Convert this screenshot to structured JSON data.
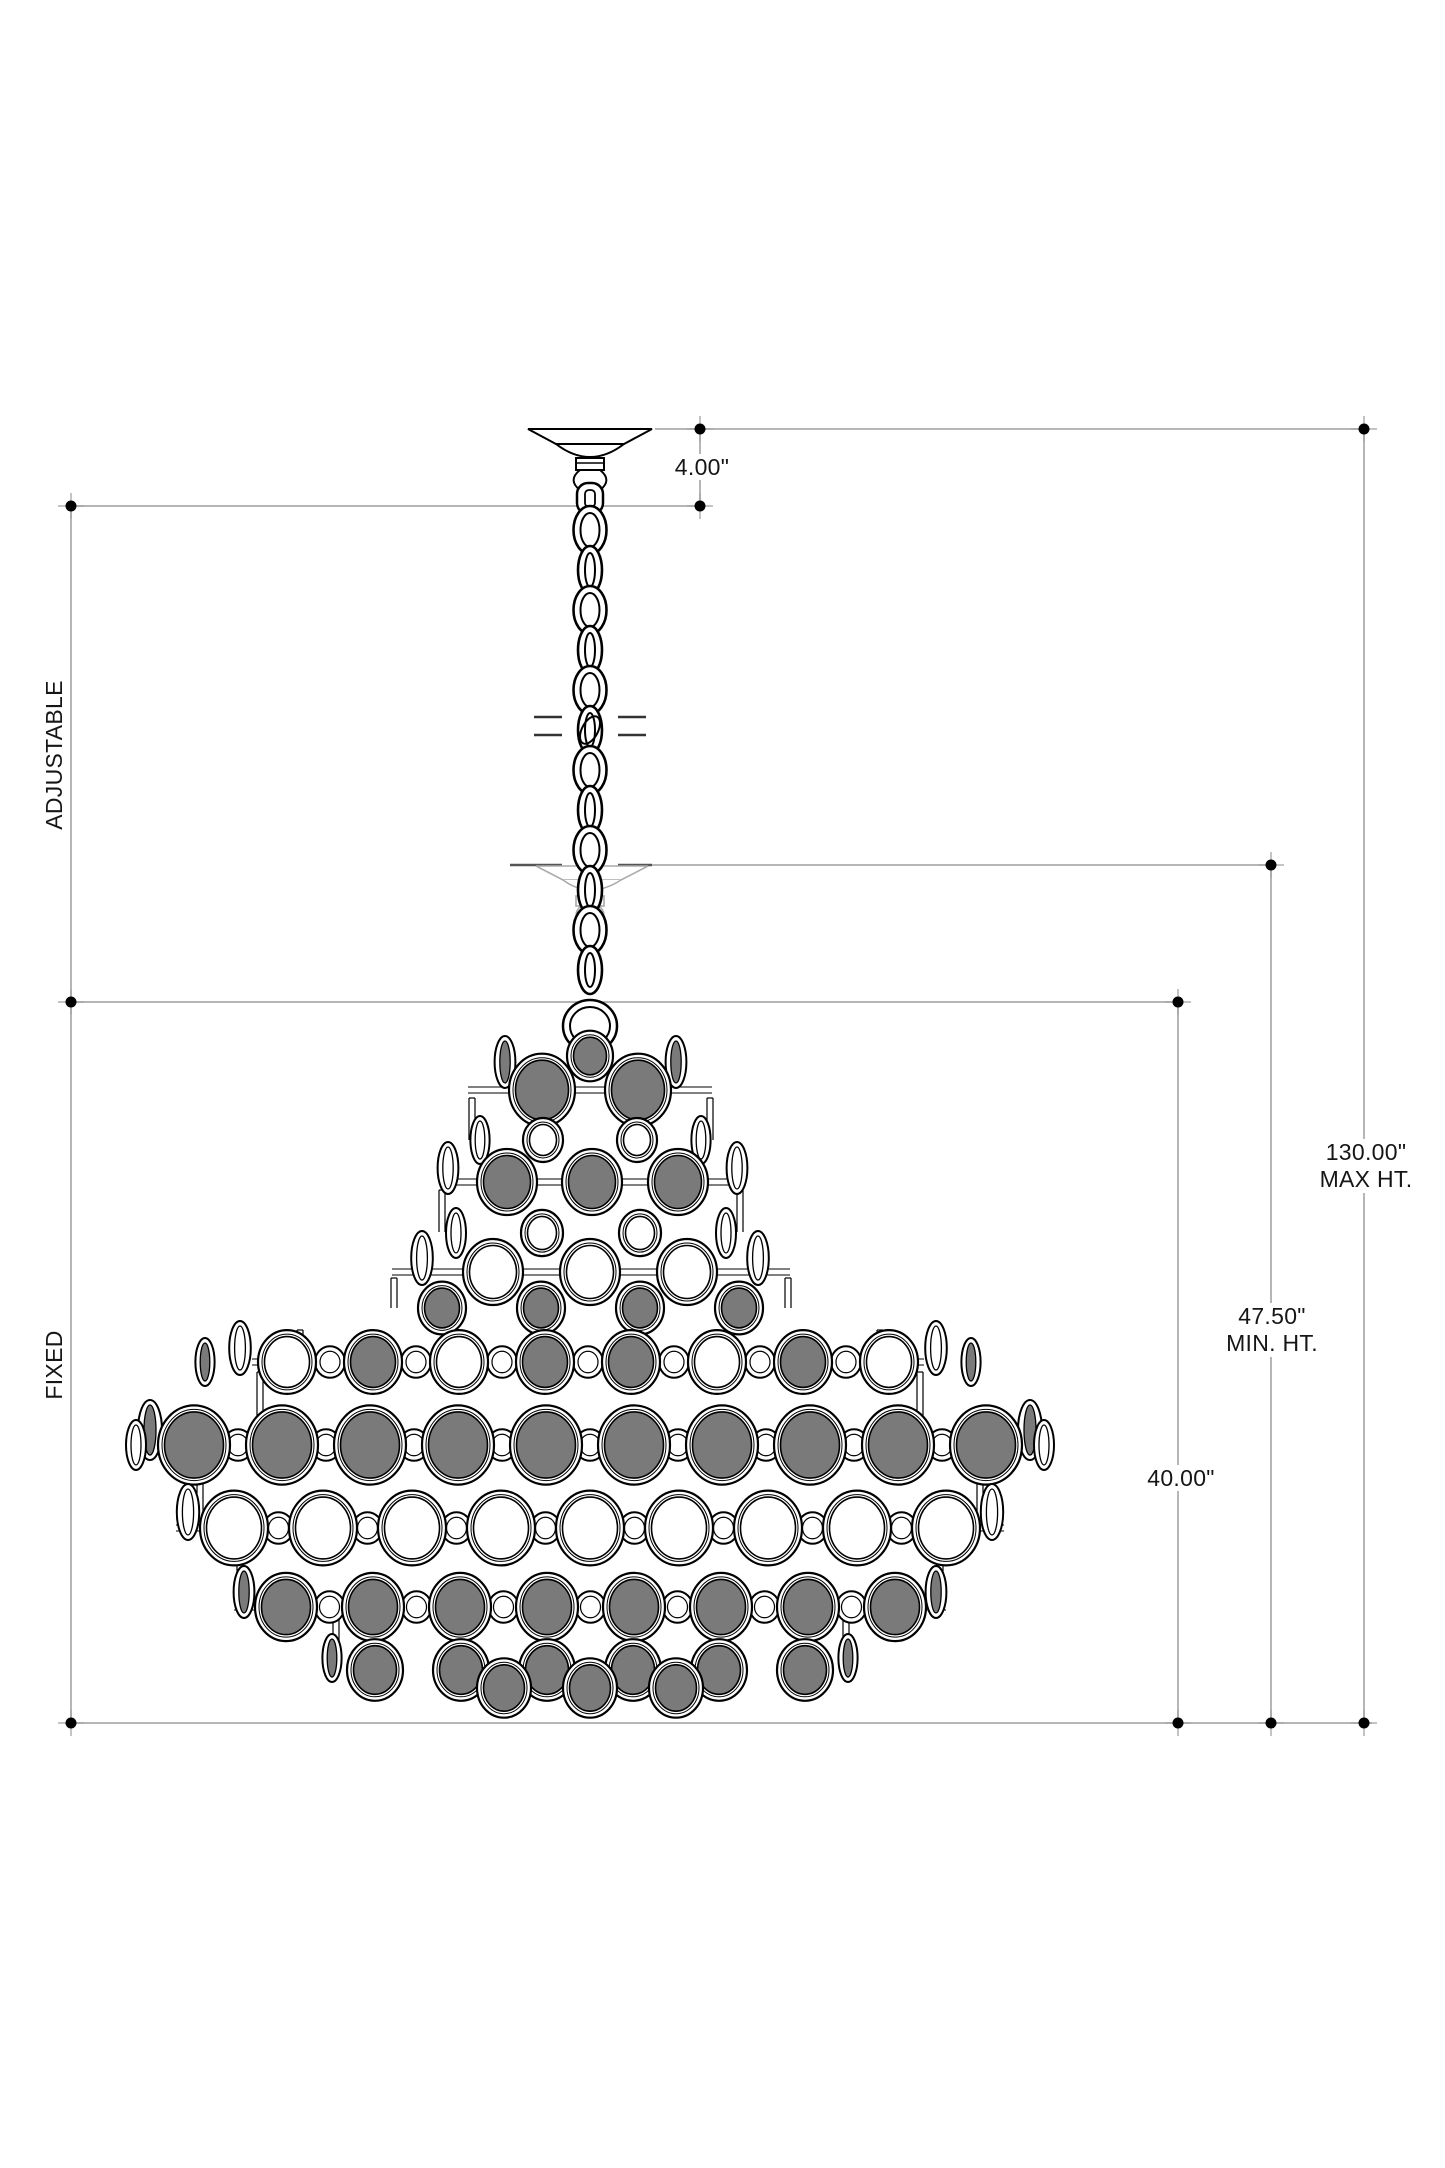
{
  "diagram": {
    "title": "chandelier-elevation-dimension-drawing",
    "dimensions": {
      "canopy_drop": "4.00\"",
      "adjustable_label": "ADJUSTABLE",
      "fixed_label": "FIXED",
      "max_height_value": "130.00\"",
      "max_height_label": "MAX HT.",
      "min_height_value": "47.50\"",
      "min_height_label": "MIN. HT.",
      "fixture_height": "40.00\""
    },
    "colors": {
      "dimension_line": "#9e9e9e",
      "dimension_dot": "#000000",
      "outline": "#000000",
      "glass_gray": "#7a7a7a",
      "ghost_line": "#aaaaaa",
      "ghost_dark_dash": "#555555",
      "break_mark": "#333333"
    }
  }
}
